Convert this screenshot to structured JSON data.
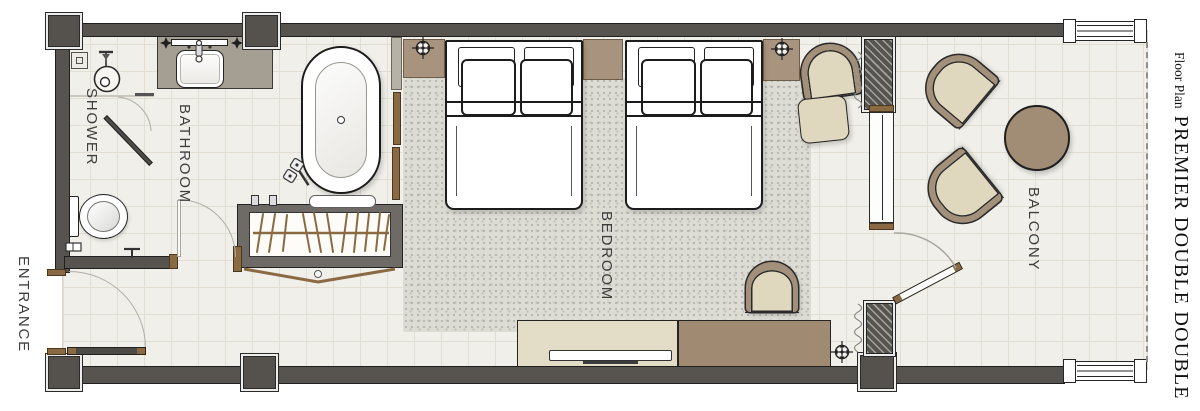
{
  "title": {
    "prefix": "Floor Plan",
    "name": "PREMIER DOUBLE DOUBLE"
  },
  "rooms": {
    "shower": "SHOWER",
    "bathroom": "BATHROOM",
    "entrance": "ENTRANCE",
    "bedroom": "BEDROOM",
    "balcony": "BALCONY"
  },
  "colors": {
    "wall": "#57534e",
    "outline": "#1f1f1f",
    "wood": "#8a6a43",
    "floor": "#f0efe9",
    "grid": "#e2ded3",
    "rug": "#dcdbd4",
    "counter": "#a49e93",
    "taupe": "#a8947e",
    "beige": "#e0d7bf",
    "chair-frame": "#a3907a",
    "console-beige": "#e3dcc6",
    "console-brown": "#a08a72",
    "table": "#a18d76",
    "label": "#3e3e3e"
  },
  "icons": {
    "sprinkler": "crosshair-circle-icon",
    "ceiling_light": "four-point-star-icon",
    "curtain": "coil-squiggle-icon",
    "shower_head": "circle-rose-icon"
  }
}
